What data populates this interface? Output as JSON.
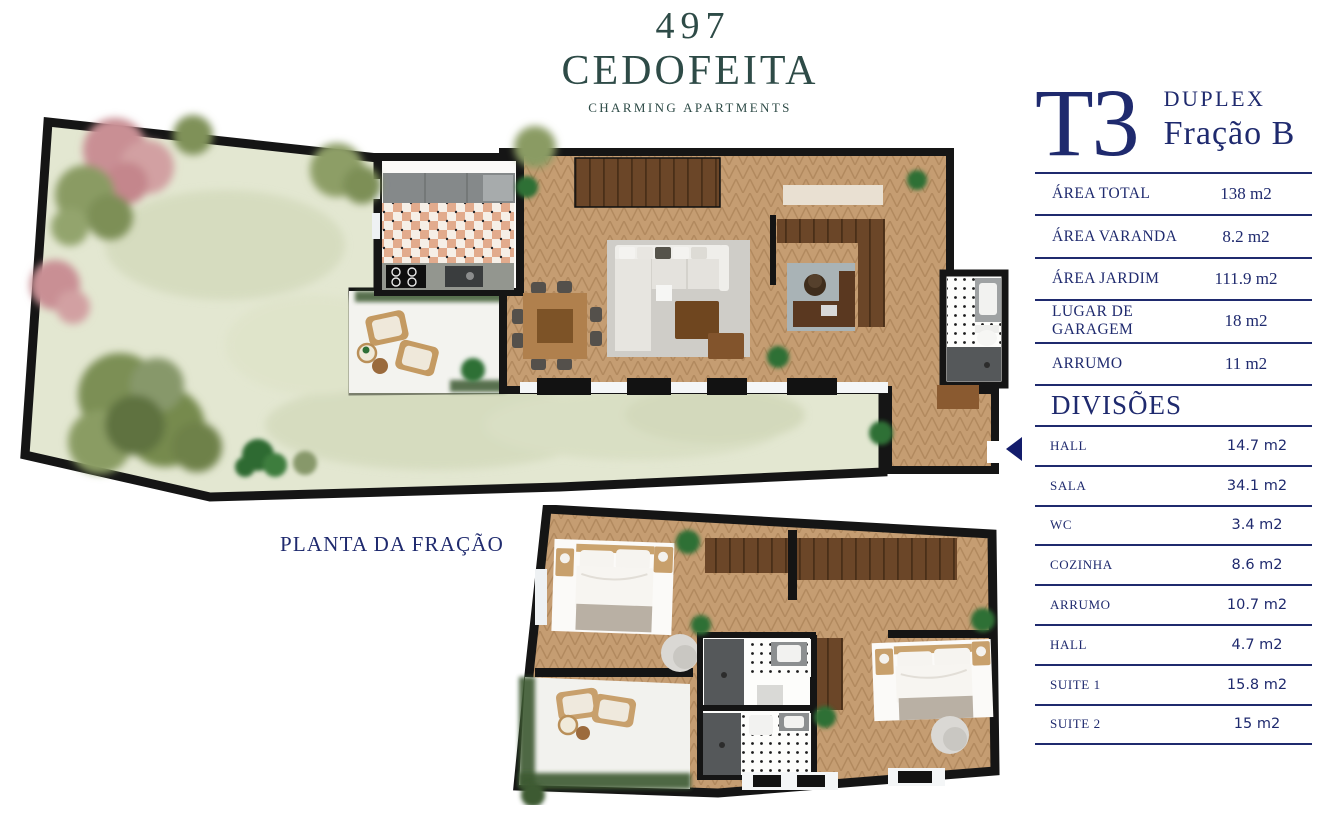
{
  "logo": {
    "number": "497",
    "name": "CEDOFEITA",
    "tagline": "CHARMING APARTMENTS"
  },
  "unit": {
    "type": "T3",
    "style": "DUPLEX",
    "fraction": "Fração B"
  },
  "areas": {
    "rows": [
      {
        "label": "ÁREA TOTAL",
        "value": "138 m2"
      },
      {
        "label": "ÁREA VARANDA",
        "value": "8.2 m2"
      },
      {
        "label": "ÁREA JARDIM",
        "value": "111.9 m2"
      },
      {
        "label": "LUGAR DE GARAGEM",
        "value": "18 m2"
      },
      {
        "label": "ARRUMO",
        "value": "11 m2"
      }
    ]
  },
  "divisions": {
    "title": "DIVISÕES",
    "rows": [
      {
        "label": "HALL",
        "value": "14.7 m2"
      },
      {
        "label": "SALA",
        "value": "34.1 m2"
      },
      {
        "label": "WC",
        "value": "3.4 m2"
      },
      {
        "label": "COZINHA",
        "value": "8.6 m2"
      },
      {
        "label": "ARRUMO",
        "value": "10.7 m2"
      },
      {
        "label": "HALL",
        "value": "4.7 m2"
      },
      {
        "label": "SUITE 1",
        "value": "15.8 m2"
      },
      {
        "label": "SUITE 2",
        "value": "15 m2"
      }
    ]
  },
  "plan": {
    "label": "PLANTA DA FRAÇÃO"
  },
  "icons": {
    "entrance_arrow": "left-pointing-triangle"
  },
  "colors": {
    "brand_green": "#2e4b47",
    "navy": "#1f2a6e",
    "wood": "#c59d72",
    "lawn": "#e3e7d1",
    "wall": "#151515"
  }
}
